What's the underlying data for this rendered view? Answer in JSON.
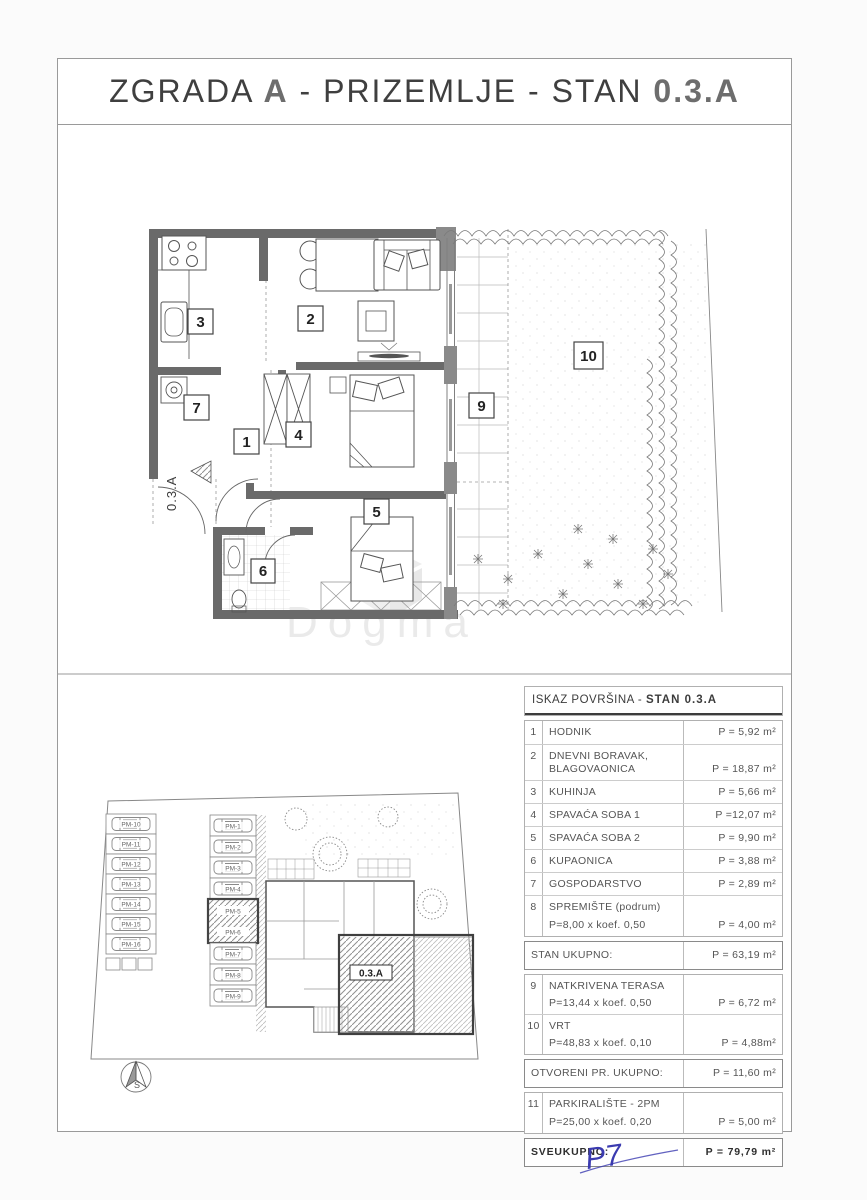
{
  "title": {
    "part1": "ZGRADA ",
    "building": "A",
    "part2": " - PRIZEMLJE - STAN ",
    "unit": "0.3.A"
  },
  "floor_plan": {
    "entrance_label": "0.3.A",
    "room_numbers": [
      "1",
      "2",
      "3",
      "4",
      "5",
      "6",
      "7",
      "9",
      "10"
    ]
  },
  "site_plan": {
    "parking_left": [
      "PM-10",
      "PM-11",
      "PM-12",
      "PM-13",
      "PM-14",
      "PM-15",
      "PM-16"
    ],
    "parking_right": [
      "PM-1",
      "PM-2",
      "PM-3",
      "PM-4",
      "PM-5",
      "PM-6",
      "PM-7",
      "PM-8",
      "PM-9"
    ],
    "unit_label": "0.3.A",
    "compass_label": "S"
  },
  "area_table": {
    "header_prefix": "ISKAZ POVRŠINA - ",
    "header_bold": "STAN 0.3.A",
    "rows": [
      {
        "num": "1",
        "label": "HODNIK",
        "value": "P = 5,92 m²"
      },
      {
        "num": "2",
        "label": "DNEVNI BORAVAK, BLAGOVAONICA",
        "value": "P = 18,87 m²"
      },
      {
        "num": "3",
        "label": "KUHINJA",
        "value": "P = 5,66 m²"
      },
      {
        "num": "4",
        "label": "SPAVAĆA SOBA 1",
        "value": "P =12,07 m²"
      },
      {
        "num": "5",
        "label": "SPAVAĆA SOBA 2",
        "value": "P = 9,90 m²"
      },
      {
        "num": "6",
        "label": "KUPAONICA",
        "value": "P = 3,88 m²"
      },
      {
        "num": "7",
        "label": "GOSPODARSTVO",
        "value": "P = 2,89 m²"
      },
      {
        "num": "8",
        "label": "SPREMIŠTE (podrum)",
        "sub": "P=8,00 x koef. 0,50",
        "value": "P = 4,00 m²"
      }
    ],
    "stan_ukupno": {
      "label": "STAN UKUPNO:",
      "value": "P = 63,19 m²"
    },
    "rows_open": [
      {
        "num": "9",
        "label": "NATKRIVENA TERASA",
        "sub": "P=13,44 x koef. 0,50",
        "value": "P = 6,72 m²"
      },
      {
        "num": "10",
        "label": "VRT",
        "sub": "P=48,83 x koef. 0,10",
        "value": "P = 4,88m²"
      }
    ],
    "otvoreni_ukupno": {
      "label": "OTVORENI PR. UKUPNO:",
      "value": "P = 11,60 m²"
    },
    "rows_parking": [
      {
        "num": "11",
        "label": "PARKIRALIŠTE - 2PM",
        "sub": "P=25,00 x koef. 0,20",
        "value": "P = 5,00 m²"
      }
    ],
    "sveukupno": {
      "label": "SVEUKUPNO:",
      "value": "P = 79,79 m²"
    }
  },
  "watermark": "Dogma",
  "annotation": "P7",
  "colors": {
    "wall": "#6a6a6a",
    "window_block": "#8a8a8a",
    "annotation_blue": "#3b3bb0",
    "paper": "#ffffff"
  }
}
